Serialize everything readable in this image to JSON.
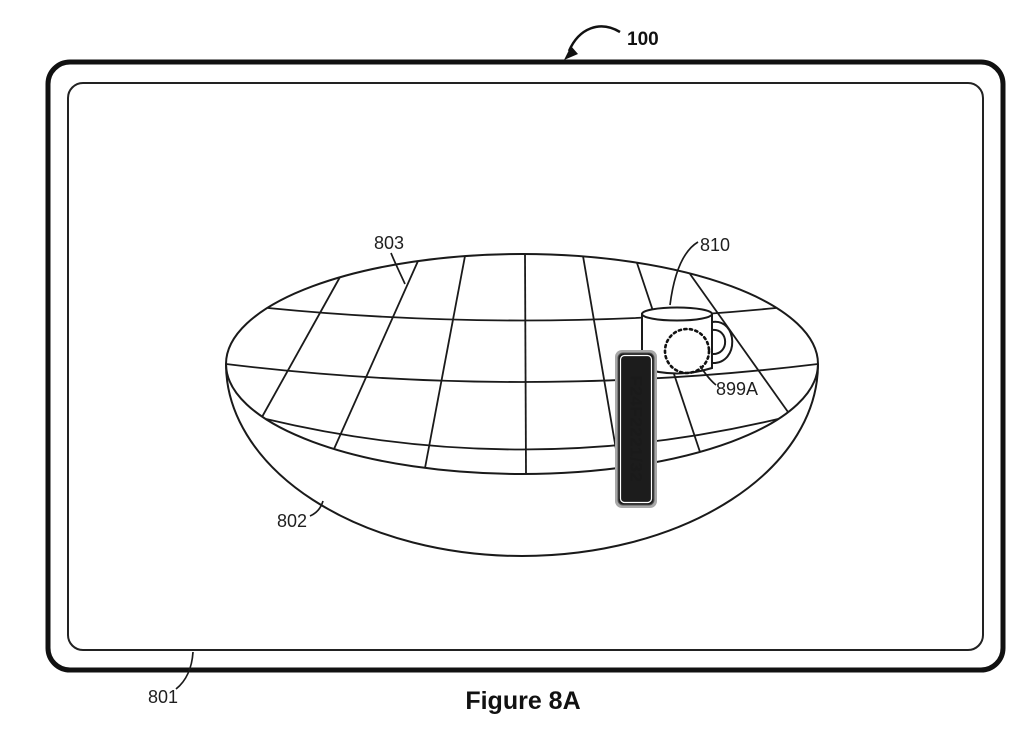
{
  "figure": {
    "caption": "Figure 8A",
    "refs": {
      "device": "100",
      "display_frame": "801",
      "bowl": "802",
      "grid_surface": "803",
      "mug": "810",
      "dotted_region": "899A"
    },
    "classification_chip": {
      "text": "F24F2221/32",
      "bg_color": "#1c1c1c",
      "text_color": "#ffffff",
      "outer_border_color": "#a8a8a8",
      "inner_border_color": "#ffffff"
    },
    "line_color": "#1a1a1a"
  }
}
